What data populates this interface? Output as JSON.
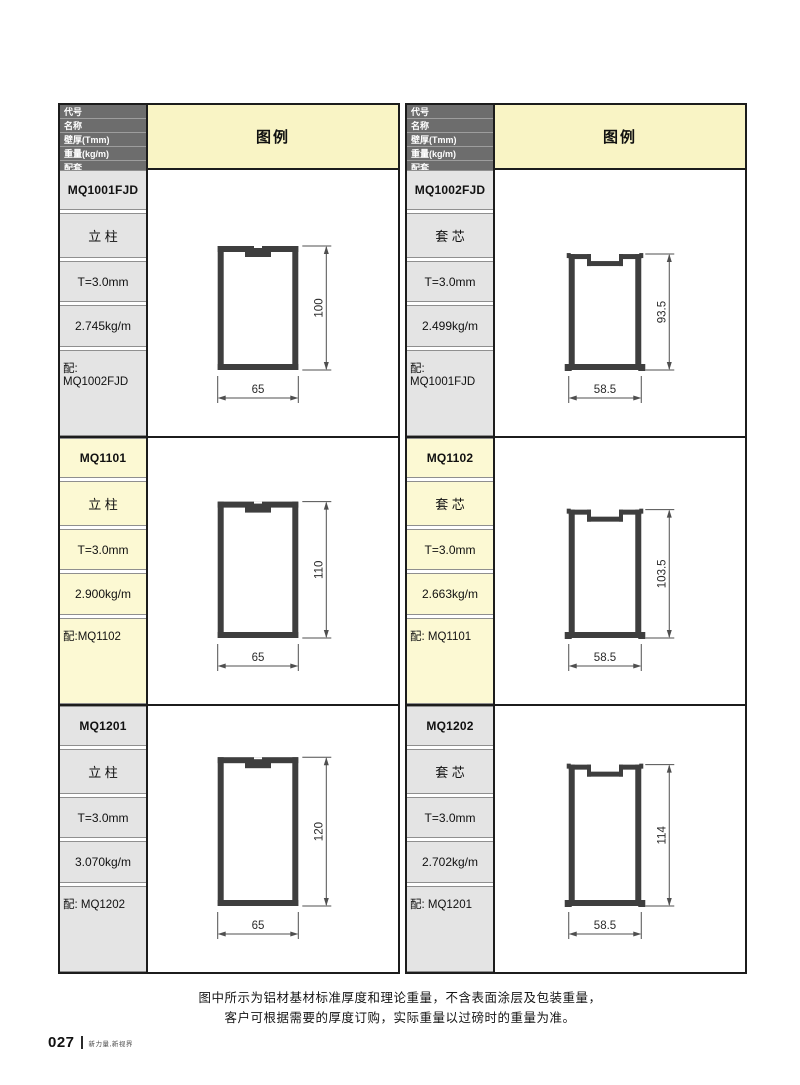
{
  "page": {
    "footer_note_line1": "图中所示为铝材基材标准厚度和理论重量，不含表面涂层及包装重量，",
    "footer_note_line2": "客户可根据需要的厚度订购，实际重量以过磅时的重量为准。",
    "page_number": "027",
    "brand_tagline": "新力量,新视界"
  },
  "table_headers": {
    "code_label": "代号",
    "name_label": "名称",
    "thickness_label": "壁厚(Tmm)",
    "weight_label": "重量(kg/m)",
    "match_label": "配套",
    "legend_label": "图例"
  },
  "columns": [
    {
      "sections": [
        {
          "code": "MQ1001FJD",
          "name": "立 柱",
          "thickness": "T=3.0mm",
          "weight": "2.745kg/m",
          "match": "配: MQ1002FJD",
          "highlight": false,
          "diagram": {
            "type": "mullion",
            "width_mm": 65,
            "height_mm": 100,
            "width_label": "65",
            "height_label": "100"
          }
        },
        {
          "code": "MQ1101",
          "name": "立 柱",
          "thickness": "T=3.0mm",
          "weight": "2.900kg/m",
          "match": "配:MQ1102",
          "highlight": true,
          "diagram": {
            "type": "mullion",
            "width_mm": 65,
            "height_mm": 110,
            "width_label": "65",
            "height_label": "110"
          }
        },
        {
          "code": "MQ1201",
          "name": "立 柱",
          "thickness": "T=3.0mm",
          "weight": "3.070kg/m",
          "match": "配: MQ1202",
          "highlight": false,
          "diagram": {
            "type": "mullion",
            "width_mm": 65,
            "height_mm": 120,
            "width_label": "65",
            "height_label": "120"
          }
        }
      ]
    },
    {
      "sections": [
        {
          "code": "MQ1002FJD",
          "name": "套 芯",
          "thickness": "T=3.0mm",
          "weight": "2.499kg/m",
          "match": "配: MQ1001FJD",
          "highlight": false,
          "diagram": {
            "type": "sleeve",
            "width_mm": 58.5,
            "height_mm": 93.5,
            "width_label": "58.5",
            "height_label": "93.5"
          }
        },
        {
          "code": "MQ1102",
          "name": "套 芯",
          "thickness": "T=3.0mm",
          "weight": "2.663kg/m",
          "match": "配: MQ1101",
          "highlight": true,
          "diagram": {
            "type": "sleeve",
            "width_mm": 58.5,
            "height_mm": 103.5,
            "width_label": "58.5",
            "height_label": "103.5"
          }
        },
        {
          "code": "MQ1202",
          "name": "套 芯",
          "thickness": "T=3.0mm",
          "weight": "2.702kg/m",
          "match": "配: MQ1201",
          "highlight": false,
          "diagram": {
            "type": "sleeve",
            "width_mm": 58.5,
            "height_mm": 114,
            "width_label": "58.5",
            "height_label": "114"
          }
        }
      ]
    }
  ],
  "colors": {
    "header_bg": "#6d6d6d",
    "header_text": "#ffffff",
    "cell_gray": "#e4e4e4",
    "highlight_yellow": "#fcf9d3",
    "legend_yellow": "#f9f4c5",
    "table_border": "#1c1c1c",
    "profile": "#3e3e3e",
    "dimension": "#4f4f4f"
  }
}
